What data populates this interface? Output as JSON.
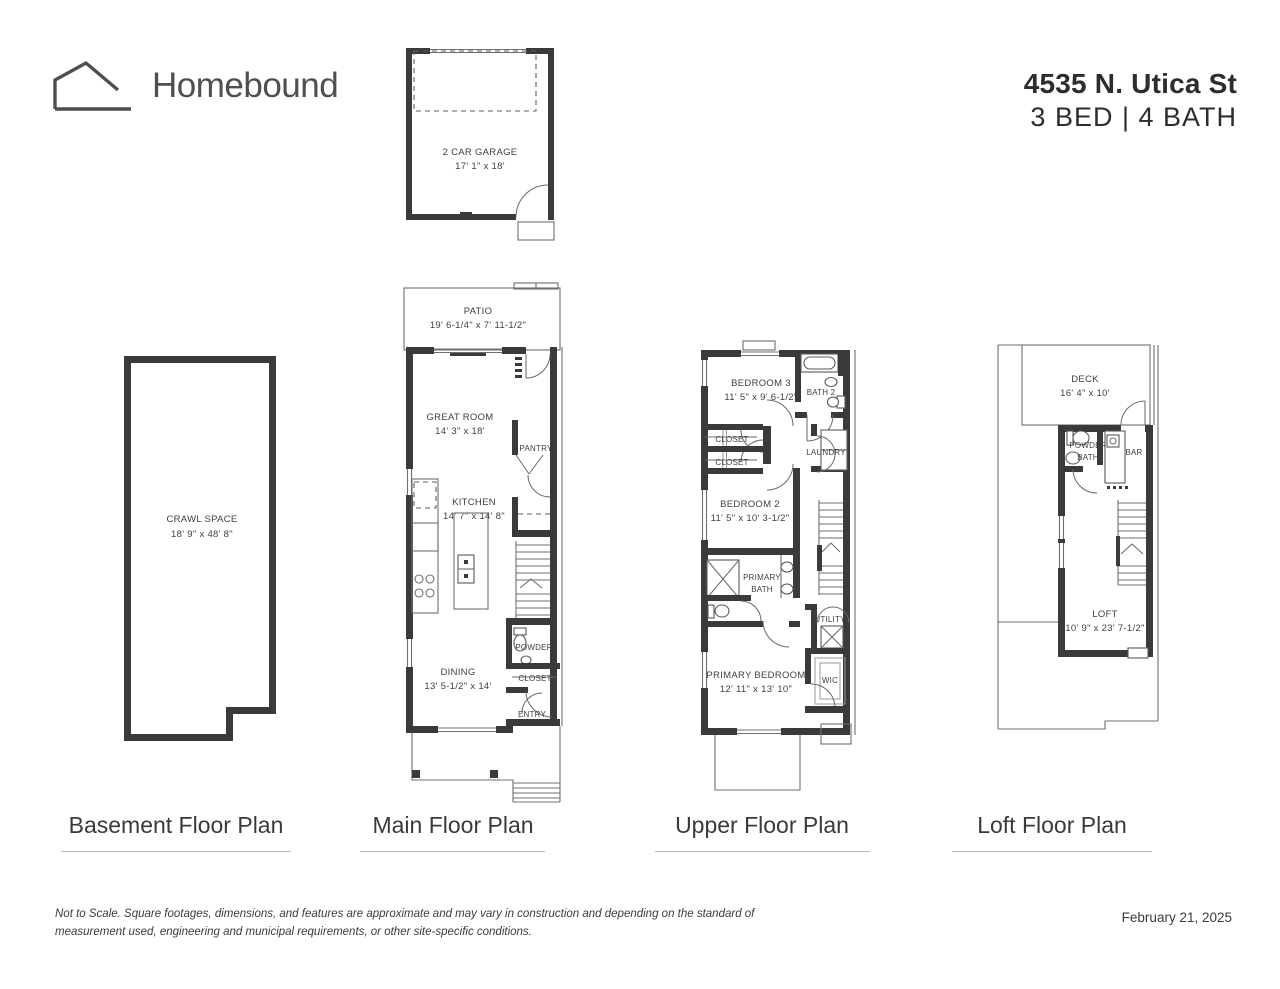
{
  "header": {
    "brand": "Homebound",
    "address": "4535 N. Utica St",
    "specs": "3 BED | 4 BATH"
  },
  "plans": {
    "basement": {
      "title": "Basement Floor Plan",
      "rooms": {
        "crawl_space": {
          "name": "CRAWL SPACE",
          "dims": "18' 9\" x 48' 8\""
        }
      }
    },
    "main": {
      "title": "Main Floor Plan",
      "rooms": {
        "garage": {
          "name": "2 CAR GARAGE",
          "dims": "17' 1\" x 18'"
        },
        "patio": {
          "name": "PATIO",
          "dims": "19' 6-1/4\" x 7' 11-1/2\""
        },
        "great_room": {
          "name": "GREAT ROOM",
          "dims": "14' 3\" x 18'"
        },
        "pantry": {
          "name": "PANTRY"
        },
        "kitchen": {
          "name": "KITCHEN",
          "dims": "14' 7\" x 14' 8\""
        },
        "powder": {
          "name": "POWDER"
        },
        "dining": {
          "name": "DINING",
          "dims": "13' 5-1/2\" x 14'"
        },
        "closet": {
          "name": "CLOSET"
        },
        "entry": {
          "name": "ENTRY"
        }
      }
    },
    "upper": {
      "title": "Upper Floor Plan",
      "rooms": {
        "bedroom3": {
          "name": "BEDROOM 3",
          "dims": "11' 5\" x 9' 6-1/2\""
        },
        "bath2": {
          "name": "BATH 2"
        },
        "closet1": {
          "name": "CLOSET"
        },
        "closet2": {
          "name": "CLOSET"
        },
        "laundry": {
          "name": "LAUNDRY"
        },
        "bedroom2": {
          "name": "BEDROOM 2",
          "dims": "11' 5\" x 10' 3-1/2\""
        },
        "primary_bath": {
          "line1": "PRIMARY",
          "line2": "BATH"
        },
        "utility": {
          "name": "UTILITY"
        },
        "primary_bedroom": {
          "name": "PRIMARY BEDROOM",
          "dims": "12' 11\" x 13' 10\""
        },
        "wic": {
          "name": "WIC"
        }
      }
    },
    "loft": {
      "title": "Loft Floor Plan",
      "rooms": {
        "deck": {
          "name": "DECK",
          "dims": "16' 4\" x 10'"
        },
        "powder_bath": {
          "line1": "POWDER",
          "line2": "BATH"
        },
        "bar": {
          "name": "BAR"
        },
        "loft": {
          "name": "LOFT",
          "dims": "10' 9\" x 23' 7-1/2\""
        }
      }
    }
  },
  "footer": {
    "disclaimer": "Not to Scale. Square footages, dimensions, and features are approximate and may vary in construction and depending on the standard of measurement used, engineering and municipal requirements, or other site-specific conditions.",
    "date": "February 21, 2025"
  }
}
